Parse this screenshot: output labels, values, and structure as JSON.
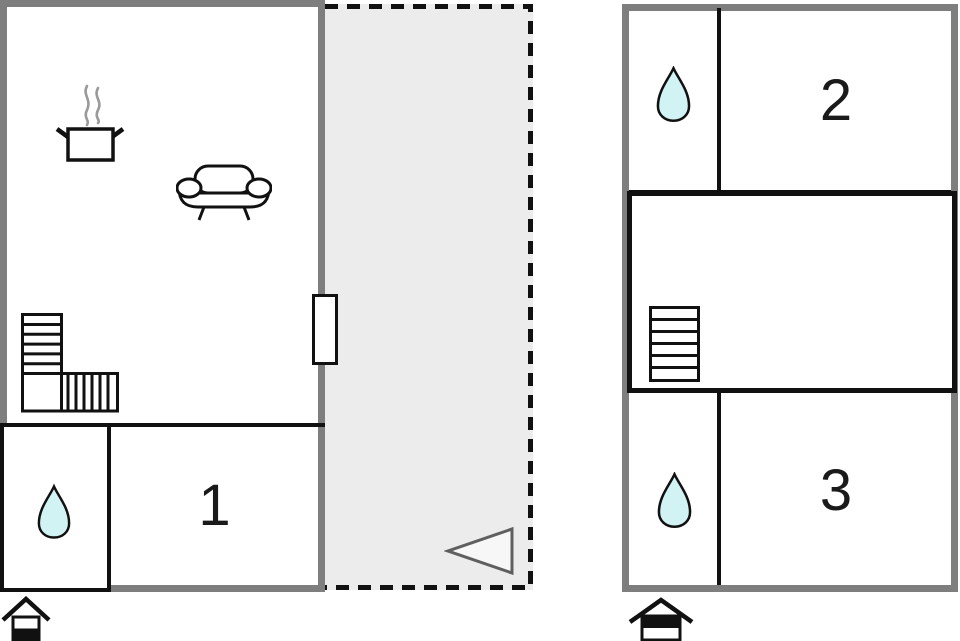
{
  "colors": {
    "wall": "#7e7e7e",
    "interior_wall": "#111111",
    "terrace_fill": "#ececec",
    "water_drop": "#d2f3f4",
    "arrow_outline": "#5f5f5f"
  },
  "ground_floor": {
    "bedroom": {
      "label": "1"
    },
    "bathroom": {
      "icon": "water-drop-icon"
    },
    "living_area": {
      "icons": [
        "pot-steam-icon",
        "sofa-icon",
        "stairs-icon",
        "door"
      ]
    },
    "terrace": {
      "icon": "direction-arrow-icon"
    },
    "level_indicator": {
      "icon": "house-lower-level-icon"
    }
  },
  "upper_floor": {
    "bedroom_2": {
      "label": "2"
    },
    "bedroom_3": {
      "label": "3"
    },
    "bathroom_top": {
      "icon": "water-drop-icon"
    },
    "bathroom_bottom": {
      "icon": "water-drop-icon"
    },
    "landing": {
      "icon": "stairs-icon"
    },
    "level_indicator": {
      "icon": "house-upper-level-icon"
    }
  }
}
